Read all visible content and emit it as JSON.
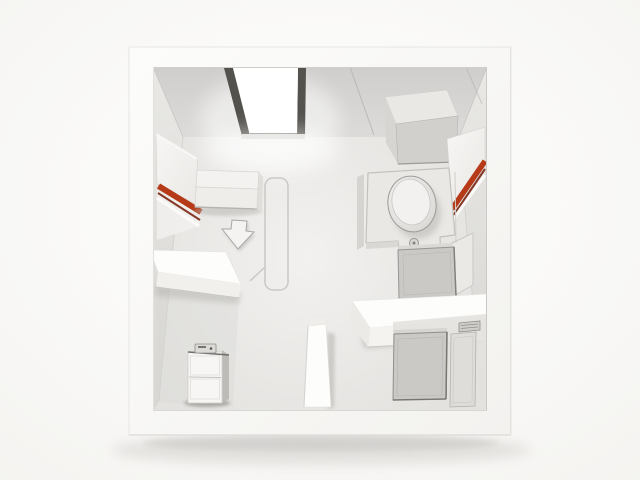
{
  "scene": {
    "title": "3D room model render",
    "style": "monochrome architectural miniature, top-down cutaway view",
    "objects": [
      {
        "name": "model-frame",
        "desc": "thick white outer wall frame of the model"
      },
      {
        "name": "skylight",
        "desc": "bright white skylight opening in ceiling, top center"
      },
      {
        "name": "ceiling-cabinet",
        "desc": "gray box mounted under ceiling, top right"
      },
      {
        "name": "window-panel-left",
        "desc": "angled wall panel with red stripes on left wall"
      },
      {
        "name": "window-panel-right",
        "desc": "angled wall panel with red stripe on right wall"
      },
      {
        "name": "desk",
        "desc": "low white sideboard against back wall, left room"
      },
      {
        "name": "arrow-decal",
        "desc": "gray arrow decal on floor pointing down"
      },
      {
        "name": "floor-marking",
        "desc": "rounded rectangle outline marked on floor"
      },
      {
        "name": "shelf-partition",
        "desc": "thick white slab partition, mid left"
      },
      {
        "name": "drawer-unit",
        "desc": "small two-drawer cabinet in bottom-left alcove"
      },
      {
        "name": "partition-wall",
        "desc": "short vertical wall stub, bottom center"
      },
      {
        "name": "toilet-platform",
        "desc": "raised L-shaped platform in right room"
      },
      {
        "name": "toilet",
        "desc": "oval toilet lid seen from above with flush button"
      },
      {
        "name": "storage-box",
        "desc": "gray box below toilet platform"
      },
      {
        "name": "counter-shelf",
        "desc": "white counter slab spanning to right wall"
      },
      {
        "name": "appliance-box",
        "desc": "large gray appliance under counter, bottom right"
      },
      {
        "name": "door-panel",
        "desc": "door on back wall of bottom-right alcove"
      },
      {
        "name": "vent-grille",
        "desc": "small vent grille above the door"
      }
    ]
  },
  "palette": {
    "background_center": "#ffffff",
    "background_edge": "#f4f3f0",
    "frame_white": "#fcfcfb",
    "frame_shade": "#f3f2ef",
    "ceiling_top": "#cfcecc",
    "ceiling_bottom": "#dcdbd9",
    "wall_light": "#e9e8e5",
    "wall_dark": "#d7d6d3",
    "floor_light": "#f2f1ef",
    "floor_dark": "#dfdedb",
    "skylight_white": "#ffffff",
    "skylight_frame": "#54524d",
    "furniture_white": "#fdfdfc",
    "desk_white": "#f3f2f0",
    "panel_white": "#f7f6f4",
    "box_gray": "#cac9c5",
    "box_gray_dark": "#8f8e8a",
    "accent_red": "#b63a17",
    "accent_red_dark": "#7c2410",
    "shadow_gray": "#d7d5d2"
  }
}
